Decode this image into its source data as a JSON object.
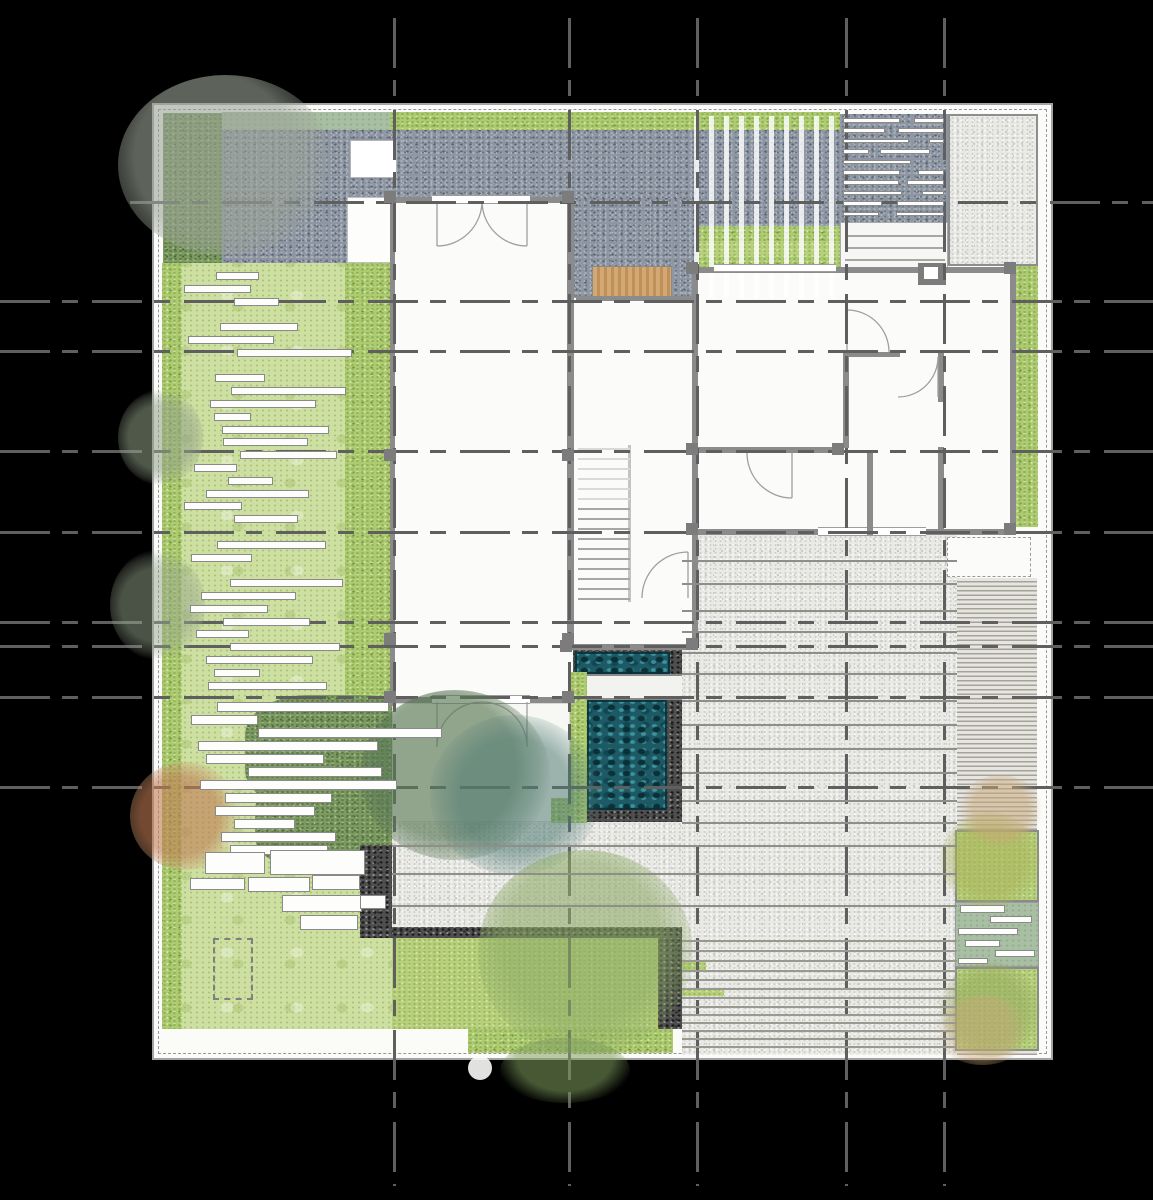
{
  "palette": {
    "background": "#000000",
    "paper": "#fbfbf9",
    "gravel_dark": "#8d96a2",
    "gravel_light": "#e9e9e6",
    "gravel_black": "#4f4f4f",
    "lawn": "#cde0a1",
    "lawn_bright": "#b8d07c",
    "hedge": "#aecb72",
    "hedge_dark": "#7d9a62",
    "sage": "#a9bfa4",
    "timber": "#cda371",
    "pool_water": "#1d5a66",
    "wall": "#8b8b8b",
    "pier": "#7c7c7c",
    "grid_line": "#5f5f5f",
    "stone_border": "#8a8a8a",
    "tree_gray": "#9ba394",
    "tree_green": "#96b46e",
    "tree_dark": "#5e8257",
    "tree_teal": "#4f7a72",
    "tree_orange": "#c07a52",
    "tree_tan": "#c9a878"
  },
  "plan": {
    "areas": [
      {
        "name": "house ground floor"
      },
      {
        "name": "dark gravel forecourt"
      },
      {
        "name": "slatted pergola canopy"
      },
      {
        "name": "stone plank pathway"
      },
      {
        "name": "light gravel terrace"
      },
      {
        "name": "west lawn with stepping stones"
      },
      {
        "name": "south-west garden lawn"
      },
      {
        "name": "plunge pool water feature"
      },
      {
        "name": "paved bridge over pool"
      },
      {
        "name": "stepped stone terrace"
      },
      {
        "name": "timber deck boards"
      },
      {
        "name": "sunken lawn court"
      },
      {
        "name": "raised planter with tree"
      },
      {
        "name": "clipped hedge border"
      },
      {
        "name": "internal staircase"
      },
      {
        "name": "timber threshold deck"
      }
    ]
  }
}
